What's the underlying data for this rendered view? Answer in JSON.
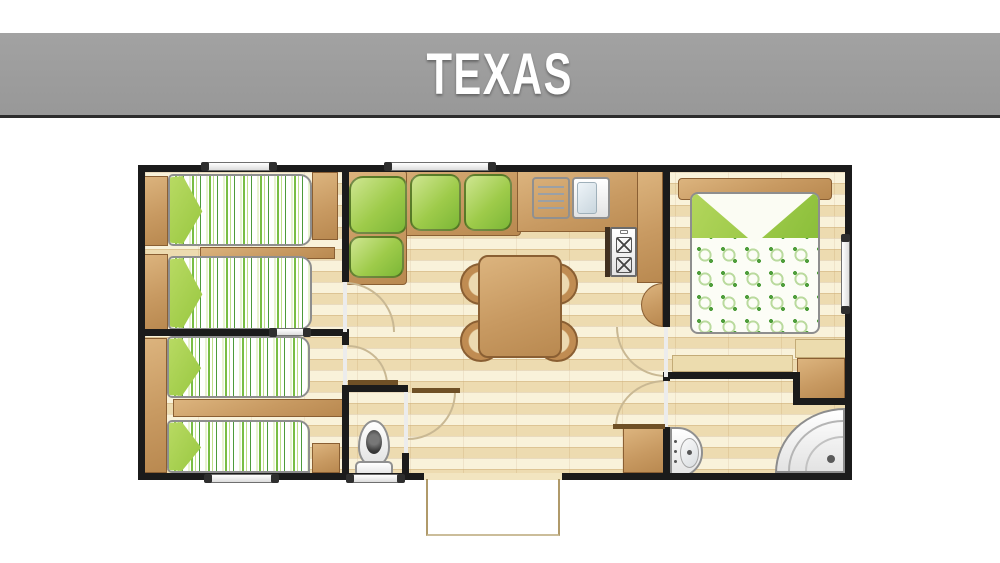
{
  "title": {
    "text": "TEXAS"
  },
  "plan": {
    "model_name": "TEXAS",
    "type": "mobile-home floor plan, top view",
    "rooms": [
      {
        "id": "bedroom-twin-1",
        "label": "Twin bedroom 1 (top left)",
        "furniture": [
          "wardrobe-left-upper",
          "single-bed-1",
          "single-bed-2",
          "shelf-between-beds",
          "wardrobe-right"
        ]
      },
      {
        "id": "bedroom-twin-2",
        "label": "Twin bedroom 2 (bottom left)",
        "furniture": [
          "wardrobe-column",
          "single-bed-3",
          "single-bed-4",
          "shelf-between-beds",
          "bedside-cabinet"
        ]
      },
      {
        "id": "living-dining",
        "label": "Living / dining room (center)",
        "furniture": [
          "l-shaped-corner-sofa",
          "dining-table",
          "chair-1",
          "chair-2",
          "chair-3",
          "chair-4",
          "hall-cabinet"
        ]
      },
      {
        "id": "kitchen",
        "label": "Kitchenette (top center)",
        "furniture": [
          "worktop-counter",
          "draining-board",
          "sink",
          "two-burner-hob",
          "half-round-table"
        ]
      },
      {
        "id": "wc",
        "label": "Separate WC (bottom center-left)",
        "furniture": [
          "toilet"
        ]
      },
      {
        "id": "shower-room",
        "label": "Shower room (bottom right)",
        "furniture": [
          "washbasin",
          "corner-shower"
        ]
      },
      {
        "id": "master-bedroom",
        "label": "Master bedroom (right)",
        "furniture": [
          "double-bed",
          "headboard",
          "desk-shelf",
          "corner-shelf",
          "wardrobe"
        ]
      }
    ],
    "openings": {
      "windows_top_wall": 2,
      "windows_bottom_wall": 2,
      "windows_right_wall": 1,
      "interior_window_bedroom_divider": 1,
      "entrance": "bottom-center doorway with porch step outline",
      "interior_doors": [
        "bedroom-1",
        "bedroom-2",
        "wc",
        "shower-room",
        "master-bedroom"
      ]
    },
    "colors": {
      "banner_gray": "#9c9c9c",
      "banner_border": "#2c2c2c",
      "title_text": "#ffffff",
      "wall_black": "#1b1b1b",
      "floor_cream": "#f2e5c0",
      "floor_line_tan": "#b08850",
      "furniture_wood": "#c89a62",
      "sofa_green": "#8cc440",
      "bedding_stripe_green": "#79bd43",
      "pillow_green": "#9fcc3b",
      "duvet_pattern_green": "#4f9e3c",
      "fixture_white": "#ffffff"
    }
  }
}
